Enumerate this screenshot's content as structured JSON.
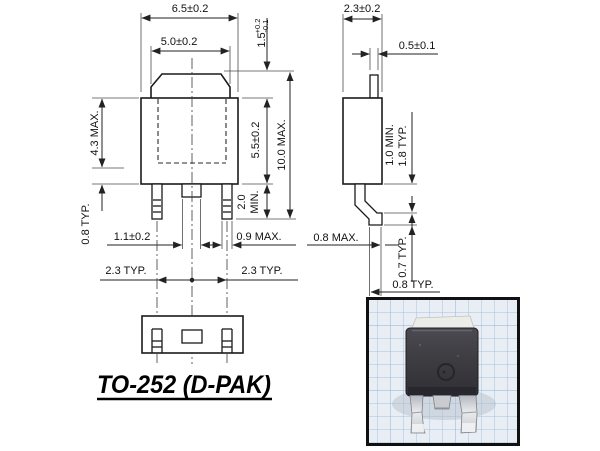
{
  "drawing": {
    "title": "TO-252 (D-PAK)",
    "front_view": {
      "overall_width": "6.5±0.2",
      "tab_width": "5.0±0.2",
      "tab_height": {
        "value": "1.5",
        "tol_plus": "+0.2",
        "tol_minus": "-0.1"
      },
      "body_top_to_lead": "4.3 MAX.",
      "lead_thickness": "0.8 TYP.",
      "center_lead_width": "1.1±0.2",
      "outer_lead_width": "0.9 MAX.",
      "lead_length_value": "2.0",
      "lead_length_qual": "MIN.",
      "body_height": "5.5±0.2",
      "overall_height": "10.0 MAX.",
      "lead_pitch_left": "2.3 TYP.",
      "lead_pitch_right": "2.3 TYP."
    },
    "side_view": {
      "body_thickness": "2.3±0.2",
      "tab_thickness": "0.5±0.1",
      "standoff_min": "1.0 MIN.",
      "standoff_typ": "1.8 TYP.",
      "lead_thickness": "0.8 MAX.",
      "foot_height": "0.7 TYP.",
      "foot_length": "0.8 TYP."
    }
  },
  "colors": {
    "line": "#1a1a1a",
    "photo_border": "#111111",
    "photo_paper": "#e9eef4",
    "photo_grid": "#a3c2e0",
    "component_body": "#3e3d42",
    "lead_metal": "#d6d8dc"
  }
}
